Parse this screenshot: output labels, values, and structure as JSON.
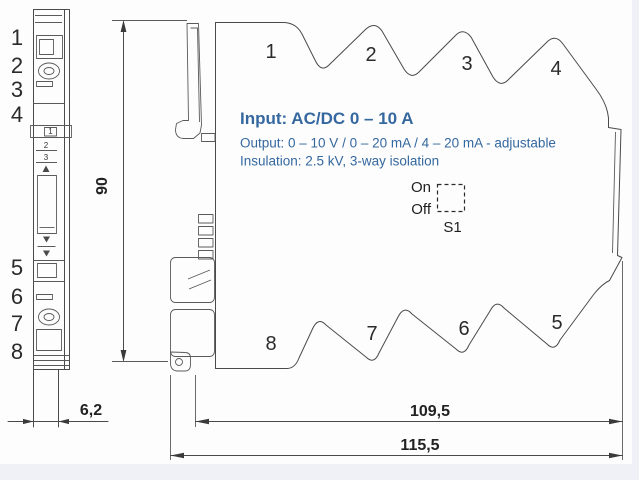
{
  "title": "DIN rail signal converter dimensional drawing",
  "specs": {
    "input": "Input: AC/DC 0 – 10 A",
    "output": "Output: 0 – 10 V / 0 – 20 mA / 4 – 20 mA - adjustable",
    "insulation": "Insulation: 2.5 kV, 3-way isolation"
  },
  "switch": {
    "on": "On",
    "off": "Off",
    "label": "S1"
  },
  "front_view": {
    "terminals_top": [
      "1",
      "2",
      "3",
      "4"
    ],
    "terminals_bottom": [
      "5",
      "6",
      "7",
      "8"
    ],
    "mini_labels": [
      "1",
      "2",
      "3"
    ]
  },
  "side_view": {
    "terminals_top": [
      "1",
      "2",
      "3",
      "4"
    ],
    "terminals_bottom": [
      "8",
      "7",
      "6",
      "5"
    ]
  },
  "dimensions": {
    "height_mm": "90",
    "front_width_mm": "6,2",
    "depth_inner_mm": "109,5",
    "depth_overall_mm": "115,5"
  },
  "colors": {
    "line": "#4a4a4a",
    "numbers": "#2b2b2b",
    "spec_text": "#35689f",
    "background": "#fdfdfe",
    "edge_strip": "#eff1f6"
  }
}
